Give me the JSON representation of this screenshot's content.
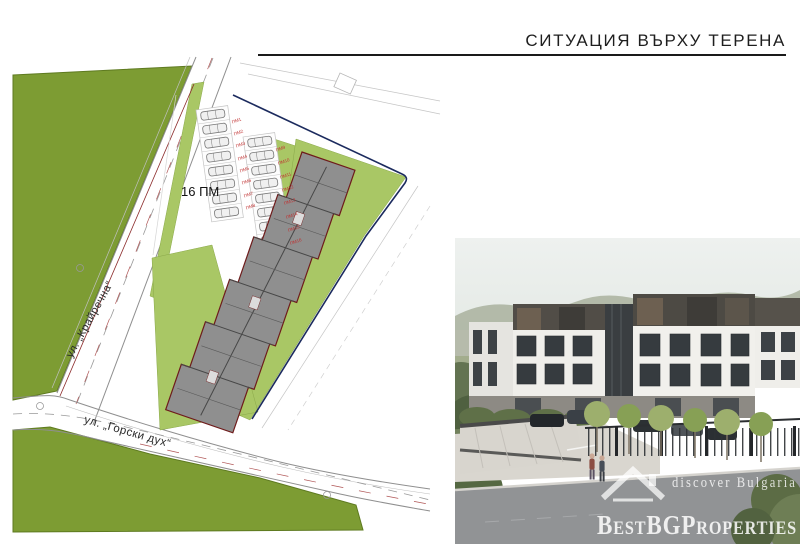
{
  "header": {
    "title": "СИТУАЦИЯ ВЪРХУ ТЕРЕНА"
  },
  "site_plan": {
    "parking_total_label": "16 ПМ",
    "streets": {
      "left": "ул. „Крайречна“",
      "bottom": "ул. „Горски дух“"
    },
    "parking_labels": [
      "ПМ1",
      "ПМ2",
      "ПМ3",
      "ПМ4",
      "ПМ5",
      "ПМ6",
      "ПМ7",
      "ПМ8",
      "ПМ9",
      "ПМ10",
      "ПМ11",
      "ПМ12",
      "ПМ13",
      "ПМ14",
      "ПМ15",
      "ПМ16"
    ],
    "colors": {
      "greenery_dark": "#7d9c33",
      "greenery_light": "#a9c765",
      "building_fill": "#8f8f8f",
      "building_outline": "#6e1b1b",
      "boundary_line": "#1c2b5e",
      "parking_label": "#c03030"
    }
  },
  "watermark": {
    "tagline": "discover Bulgaria",
    "brand": "BestBGProperties",
    "color": "#ffffff"
  }
}
